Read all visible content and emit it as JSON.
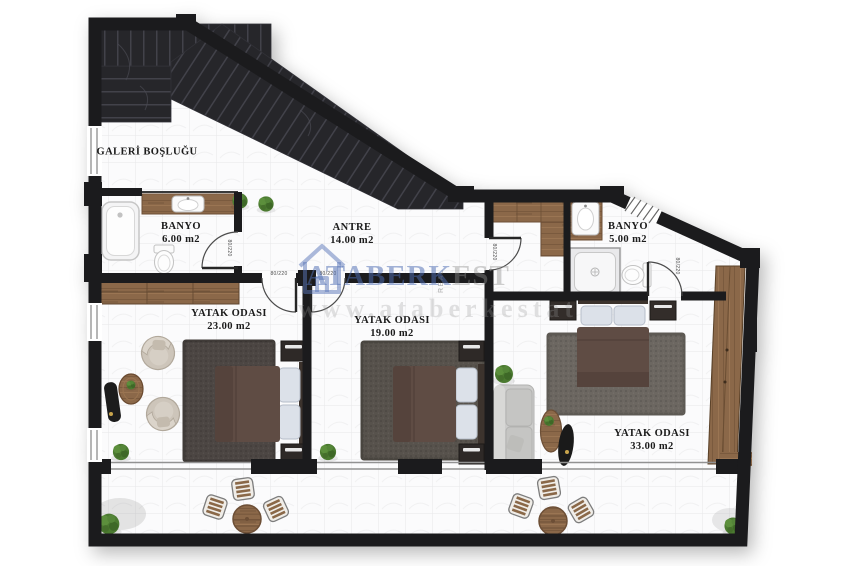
{
  "page": {
    "background": "#ffffff"
  },
  "colors": {
    "wall": "#1b1b1d",
    "floor_tile": "#fbfbfc",
    "tile_line": "#e7e7e9",
    "stair_dark": "#26262a",
    "wood": "#8b6849",
    "rug_dark": "#4c4643",
    "rug_mid": "#57524c",
    "rug_light": "#6c6761",
    "bed": "#5f4c44",
    "pillow": "#dce1e9",
    "plant": "#4b7a30",
    "sofa": "#cccccb",
    "watermark_blue": "#4e6eb2",
    "watermark_gray": "#9a9a9a"
  },
  "rooms": [
    {
      "id": "gallery-void",
      "name": "GALERİ BOŞLUĞU",
      "area": ""
    },
    {
      "id": "bathroom-left",
      "name": "BANYO",
      "area": "6.00 m2"
    },
    {
      "id": "entry-hall",
      "name": "ANTRE",
      "area": "14.00 m2"
    },
    {
      "id": "bathroom-right",
      "name": "BANYO",
      "area": "5.00 m2"
    },
    {
      "id": "bedroom-left",
      "name": "YATAK ODASI",
      "area": "23.00 m2"
    },
    {
      "id": "bedroom-middle",
      "name": "YATAK ODASI",
      "area": "19.00 m2"
    },
    {
      "id": "bedroom-right",
      "name": "YATAK ODASI",
      "area": "33.00 m2"
    }
  ],
  "doors": {
    "label": "80/220"
  },
  "watermark": {
    "brand": "ATABERK",
    "vertical": "REAL",
    "suffix": "EST",
    "url": "www.ataberkestat"
  }
}
